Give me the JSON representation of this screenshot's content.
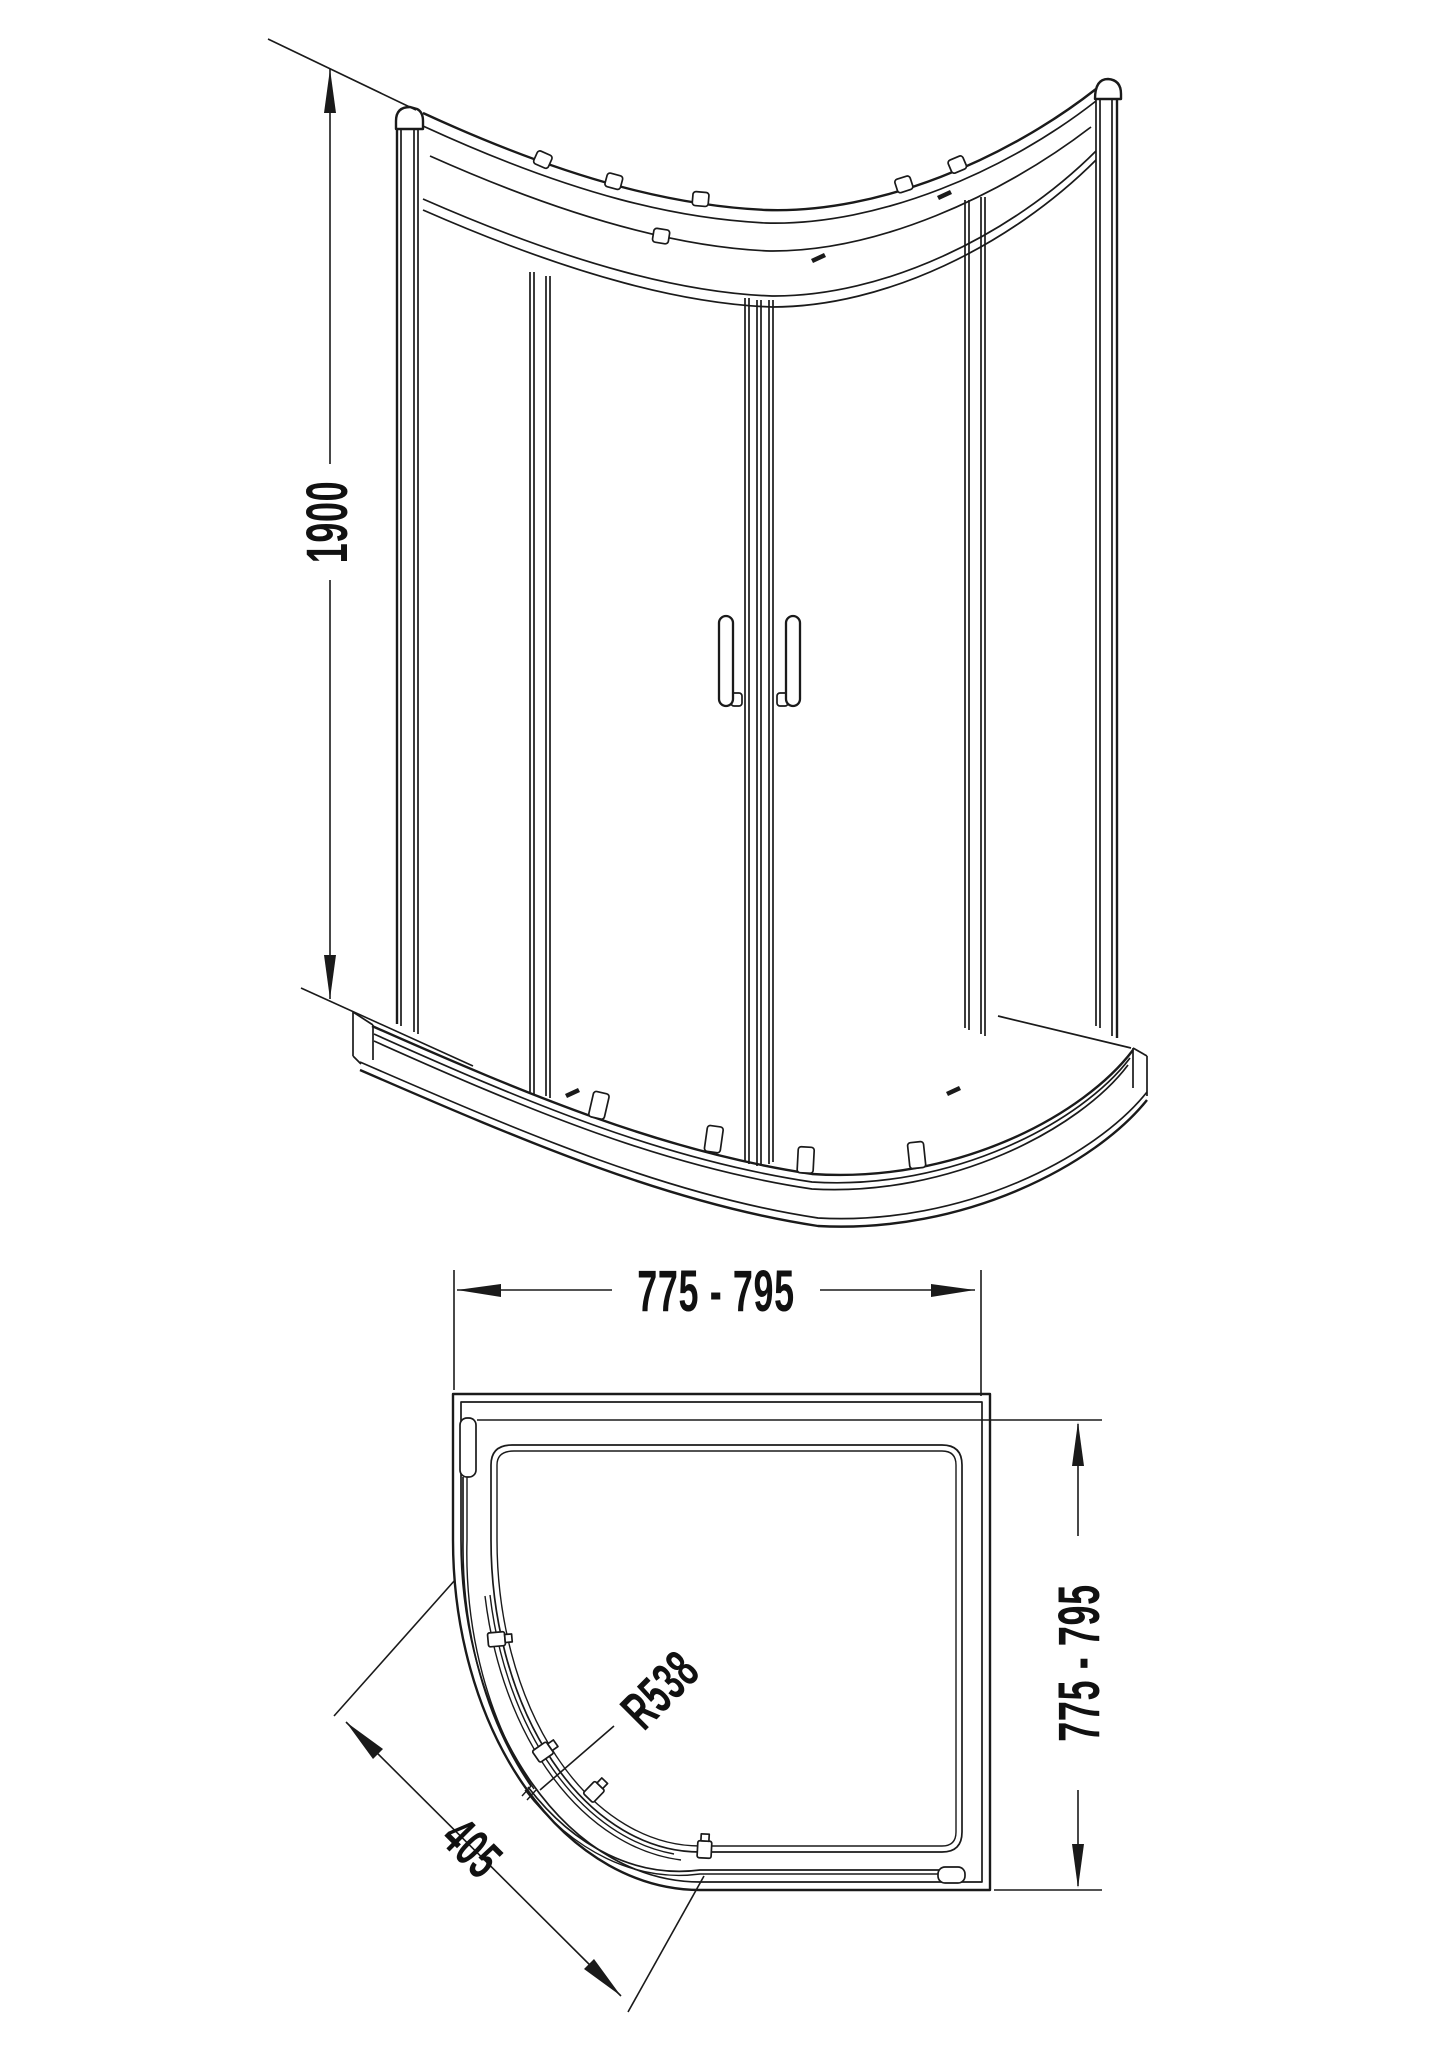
{
  "drawing": {
    "background": "#ffffff",
    "line_color": "#1a1a1a",
    "views": {
      "front_elevation": {
        "dimensions": {
          "height": "1900"
        }
      },
      "plan": {
        "dimensions": {
          "width": "775 - 795",
          "depth": "775 - 795",
          "radius": "R538",
          "door_span": "405"
        }
      }
    }
  }
}
